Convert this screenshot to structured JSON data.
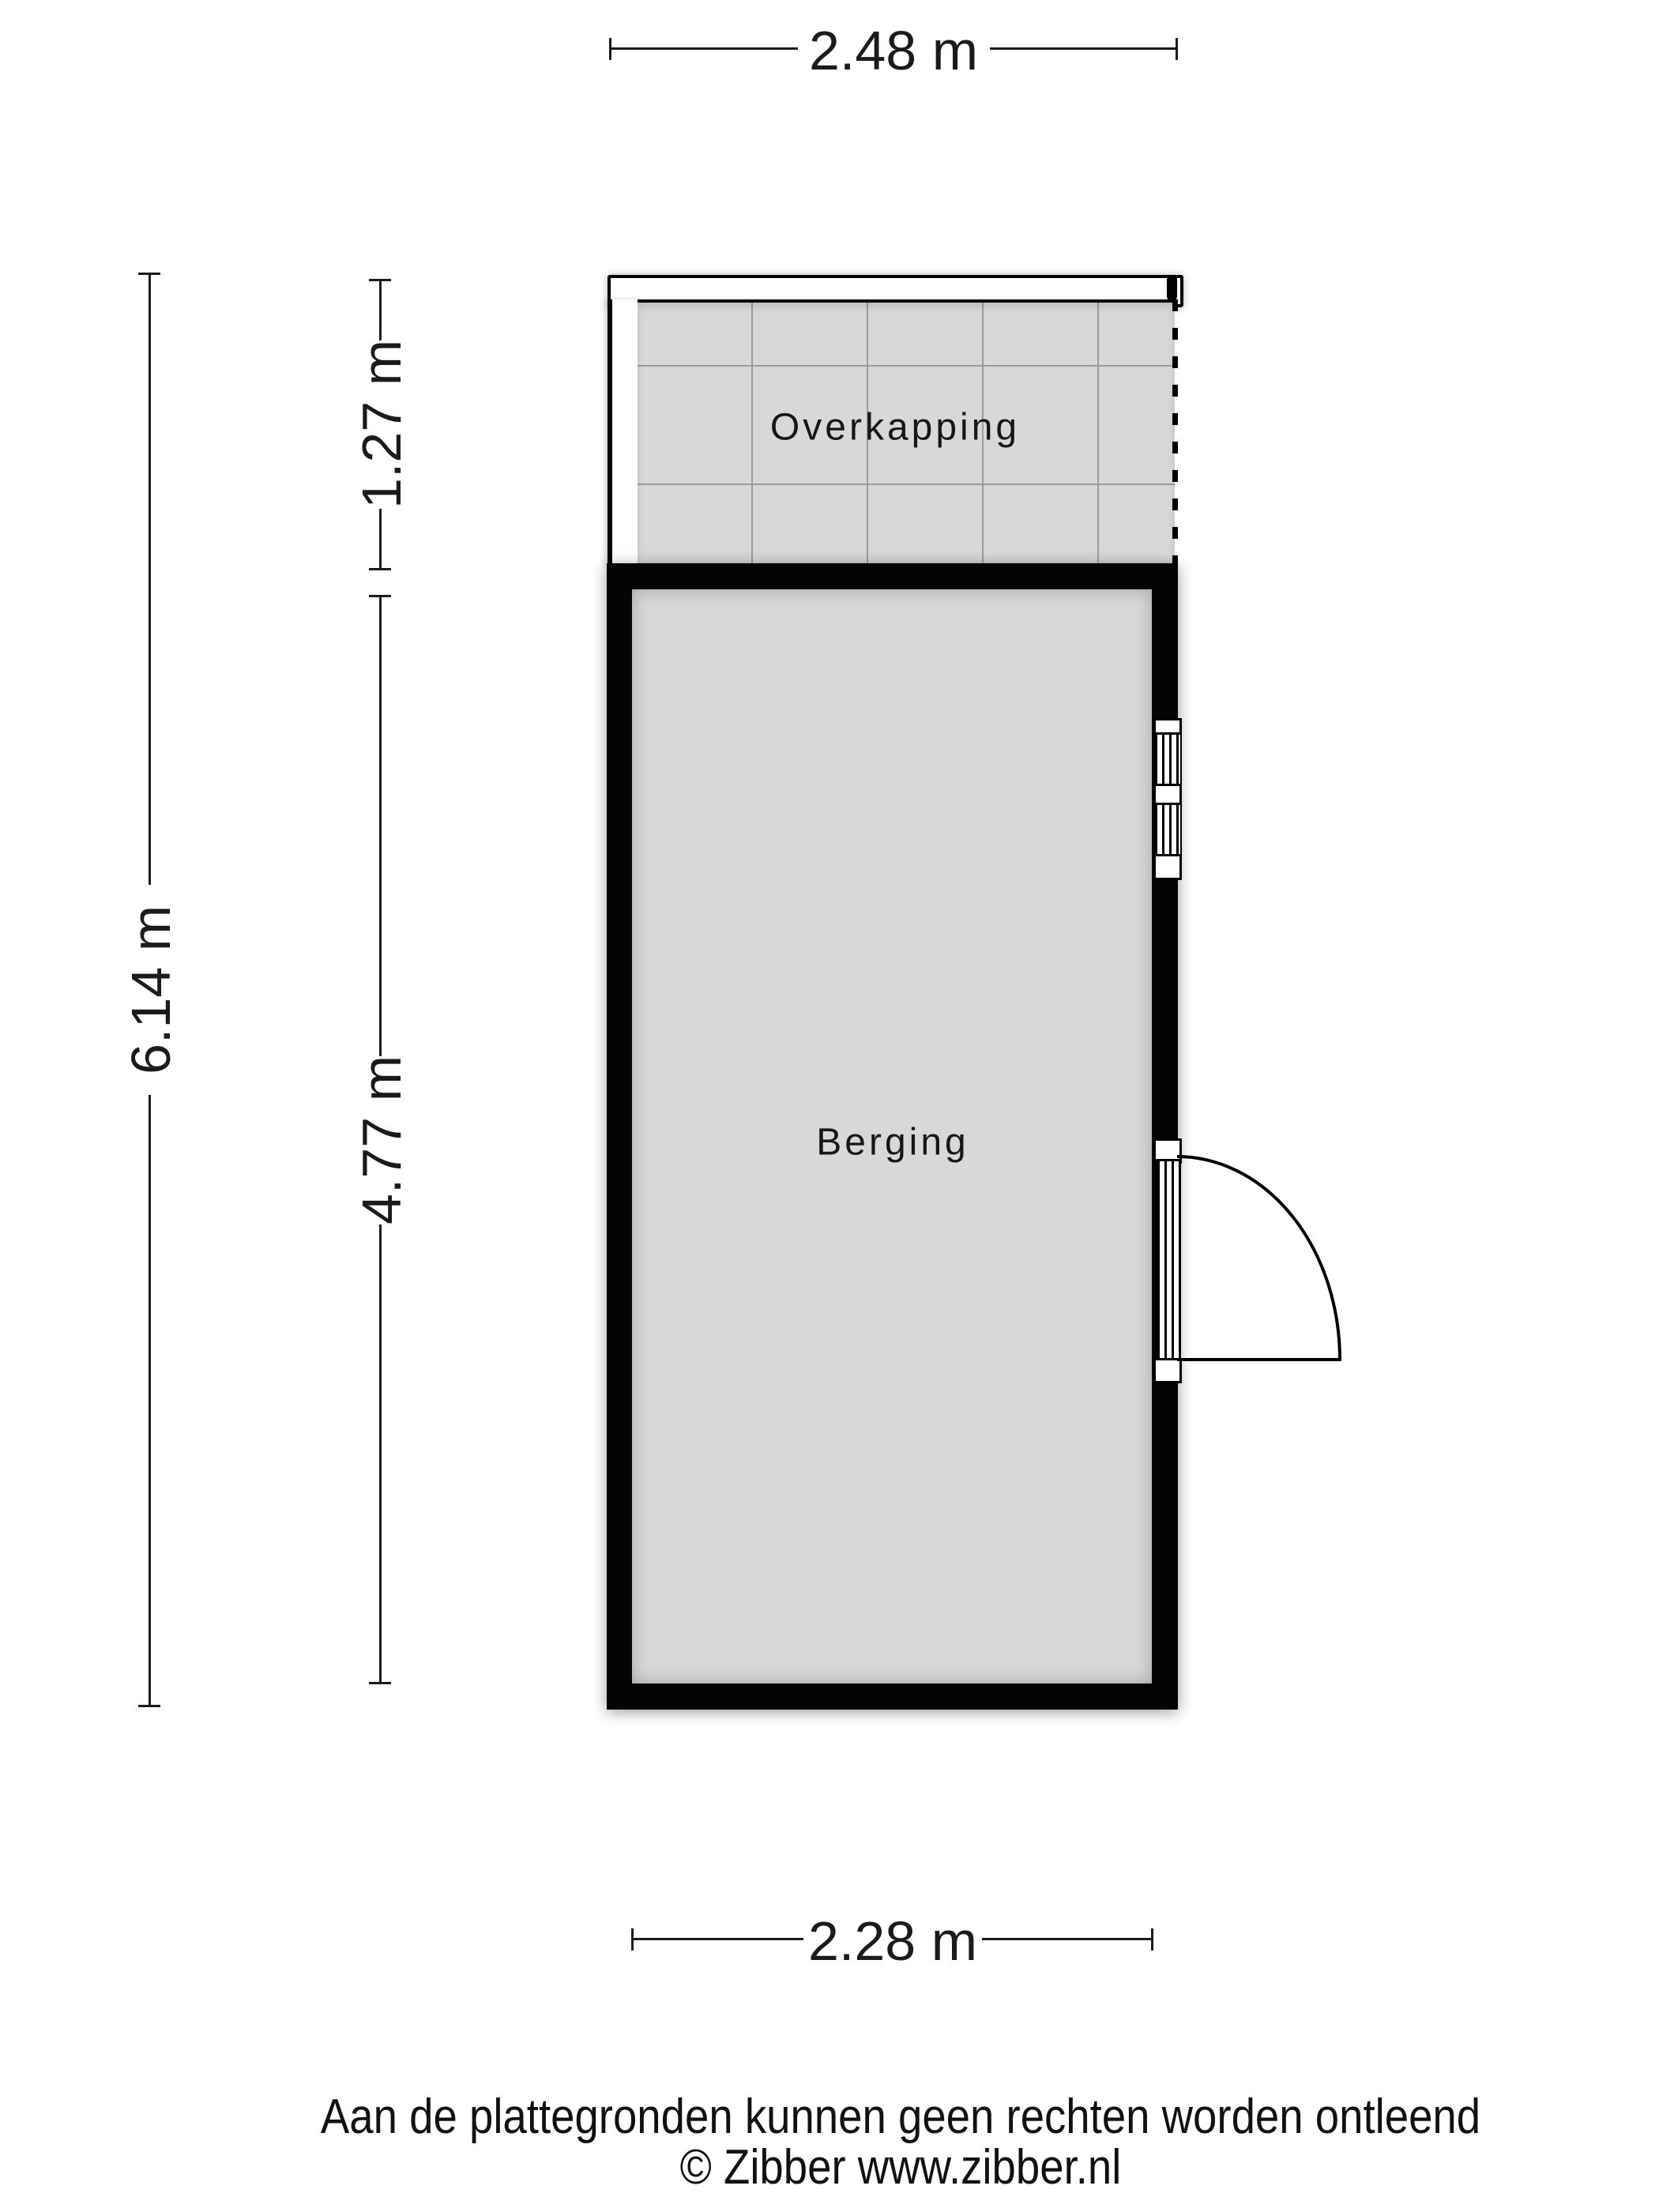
{
  "plan": {
    "rooms": [
      {
        "label": "Overkapping"
      },
      {
        "label": "Berging"
      }
    ],
    "dimensions": {
      "top": "2.48 m",
      "left_outer": "6.14 m",
      "left_inner_upper": "1.27 m",
      "left_inner_lower": "4.77 m",
      "bottom": "2.28 m"
    }
  },
  "footer": {
    "disclaimer": "Aan de plattegronden kunnen geen rechten worden ontleend",
    "copyright": "© Zibber www.zibber.nl"
  },
  "colors": {
    "floor": "#d8d8d8",
    "wall": "#000000",
    "tile_grid": "#9c9c9c",
    "text": "#1b1b1b"
  }
}
